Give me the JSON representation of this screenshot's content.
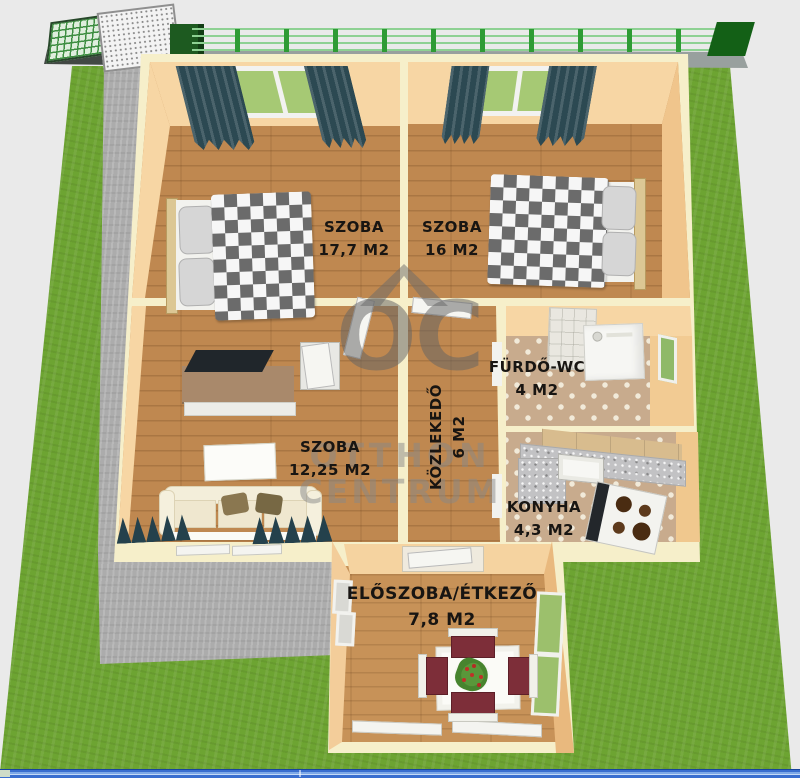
{
  "watermark": {
    "logo": "OC",
    "line1": "OTTHON",
    "line2": "CENTRUM"
  },
  "rooms": [
    {
      "id": "bedroom-1",
      "name": "SZOBA",
      "area": "17,7 M2"
    },
    {
      "id": "bedroom-2",
      "name": "SZOBA",
      "area": "16 M2"
    },
    {
      "id": "living-room",
      "name": "SZOBA",
      "area": "12,25 M2"
    },
    {
      "id": "bathroom",
      "name": "FÜRDŐ-WC",
      "area": "4 M2"
    },
    {
      "id": "hallway",
      "name": "KÖZLEKEDŐ",
      "area": "6 M2"
    },
    {
      "id": "kitchen",
      "name": "KONYHA",
      "area": "4,3 M2"
    },
    {
      "id": "entry-dining",
      "name": "ELŐSZOBA/ÉTKEZŐ",
      "area": "7,8 M2"
    }
  ],
  "colors": {
    "grass": "#6da432",
    "wall_cream": "#f6efca",
    "wall_face_peach": "#f7d6a4",
    "wood_floor": "#bf8850",
    "tile_floor": "#c8ab8d",
    "curtain_teal": "#2c4952",
    "chair_seat": "#7d2e39",
    "watermark_gray": "#8a8a8a",
    "taskbar_blue": "#3a6fd0"
  }
}
